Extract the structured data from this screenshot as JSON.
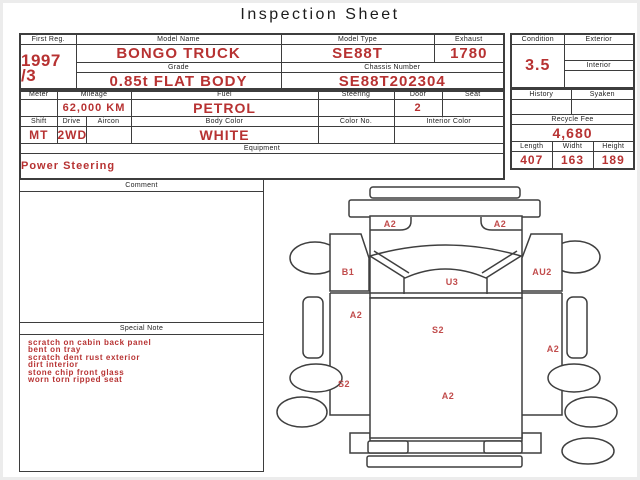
{
  "page": {
    "title": "Inspection Sheet"
  },
  "colors": {
    "value_red": "#b73232",
    "diagram_label_red": "#c14c4c",
    "border_gray": "#3d3d3d"
  },
  "top_table": {
    "first_reg_label": "First Reg.",
    "first_reg_value": "1997\n/3",
    "model_name_label": "Model Name",
    "model_name_value": "BONGO TRUCK",
    "model_type_label": "Model Type",
    "model_type_value": "SE88T",
    "exhaust_label": "Exhaust",
    "exhaust_value": "1780",
    "grade_label": "Grade",
    "grade_value": "0.85t FLAT BODY",
    "chassis_label": "Chassis Number",
    "chassis_value": "SE88T202304"
  },
  "condition_table": {
    "condition_label": "Condition",
    "condition_value": "3.5",
    "exterior_label": "Exterior",
    "exterior_value": "",
    "interior_label": "Interior",
    "interior_value": ""
  },
  "spec_table": {
    "meter_label": "Meter",
    "meter_value": "",
    "mileage_label": "Mileage",
    "mileage_value": "62,000 KM",
    "fuel_label": "Fuel",
    "fuel_value": "PETROL",
    "steering_label": "Steering",
    "steering_value": "",
    "door_label": "Door",
    "door_value": "2",
    "seat_label": "Seat",
    "seat_value": "",
    "shift_label": "Shift",
    "shift_value": "MT",
    "drive_label": "Drive",
    "drive_value": "2WD",
    "aircon_label": "Aircon",
    "aircon_value": "",
    "body_color_label": "Body Color",
    "body_color_value": "WHITE",
    "color_no_label": "Color No.",
    "color_no_value": "",
    "interior_color_label": "Interior Color",
    "interior_color_value": "",
    "equipment_label": "Equipment",
    "equipment_value": "Power Steering"
  },
  "fee_table": {
    "history_label": "History",
    "history_value": "",
    "syaken_label": "Syaken",
    "syaken_value": "",
    "recycle_fee_label": "Recycle Fee",
    "recycle_fee_value": "4,680",
    "length_label": "Length",
    "length_value": "407",
    "width_label": "Widht",
    "width_value": "163",
    "height_label": "Height",
    "height_value": "189"
  },
  "comment_box": {
    "title": "Comment",
    "body": ""
  },
  "special_note_box": {
    "title": "Special Note",
    "notes": [
      "scratch on cabin back panel",
      "bent on tray",
      "scratch dent rust exterior",
      "dirt interior",
      "stone chip front glass",
      "worn torn ripped seat"
    ]
  },
  "diagram": {
    "labels": [
      "A2",
      "A2",
      "B1",
      "AU2",
      "U3",
      "A2",
      "S2",
      "A2",
      "S2",
      "A2"
    ]
  }
}
